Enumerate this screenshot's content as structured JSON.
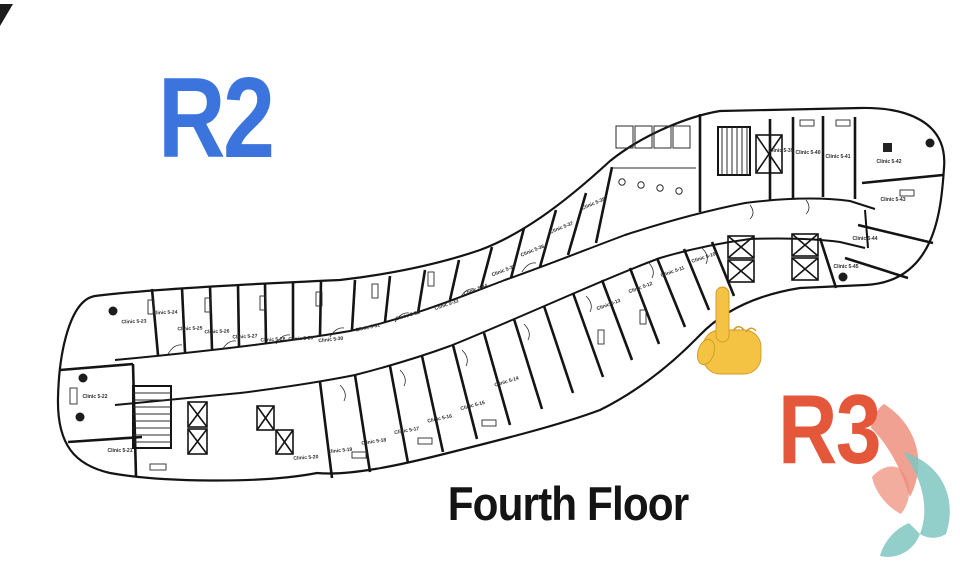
{
  "page": {
    "background": "#ffffff"
  },
  "overlays": {
    "zone_left_label": "R2",
    "zone_left_color": "#3b74dc",
    "zone_right_label": "R3",
    "zone_right_color": "#e4573a",
    "caption": "Fourth Floor",
    "caption_color": "#141414",
    "pointer_icon": "backhand-index-pointing-up",
    "pointer_fill": "#f4c343",
    "pointer_outline": "#d09a25"
  },
  "logo": {
    "coral": "#ec8a76",
    "teal": "#7fc5c1"
  },
  "floorplan": {
    "name": "fourth-floor-clinic-plan",
    "line_color": "#141414",
    "label_color": "#2a2a2a",
    "rooms": [
      {
        "label": "Clinic 5-23",
        "x": 134,
        "y": 323,
        "angle": -2
      },
      {
        "label": "Clinic 5-24",
        "x": 165,
        "y": 314,
        "angle": -2
      },
      {
        "label": "Clinic 5-25",
        "x": 190,
        "y": 330,
        "angle": -2
      },
      {
        "label": "Clinic 5-26",
        "x": 217,
        "y": 333,
        "angle": -2
      },
      {
        "label": "Clinic 5-27",
        "x": 245,
        "y": 338,
        "angle": -3
      },
      {
        "label": "Clinic 5-28",
        "x": 273,
        "y": 341,
        "angle": -3
      },
      {
        "label": "Clinic 5-29",
        "x": 301,
        "y": 340,
        "angle": -4
      },
      {
        "label": "Clinic 5-30",
        "x": 331,
        "y": 341,
        "angle": -6
      },
      {
        "label": "Clinic 5-31",
        "x": 368,
        "y": 329,
        "angle": -12
      },
      {
        "label": "Clinic 5-32",
        "x": 408,
        "y": 317,
        "angle": -16
      },
      {
        "label": "Clinic 5-33",
        "x": 447,
        "y": 306,
        "angle": -19
      },
      {
        "label": "Clinic 5-34",
        "x": 476,
        "y": 291,
        "angle": -20
      },
      {
        "label": "Clinic 5-35",
        "x": 504,
        "y": 272,
        "angle": -21
      },
      {
        "label": "Clinic 5-36",
        "x": 533,
        "y": 252,
        "angle": -22
      },
      {
        "label": "Clinic 5-37",
        "x": 562,
        "y": 229,
        "angle": -22
      },
      {
        "label": "Clinic 5-38",
        "x": 594,
        "y": 205,
        "angle": -23
      },
      {
        "label": "Clinic 5-39",
        "x": 781,
        "y": 152,
        "angle": 0
      },
      {
        "label": "Clinic 5-40",
        "x": 808,
        "y": 154,
        "angle": 0
      },
      {
        "label": "Clinic 5-41",
        "x": 838,
        "y": 158,
        "angle": 0
      },
      {
        "label": "Clinic 5-42",
        "x": 889,
        "y": 163,
        "angle": 0
      },
      {
        "label": "Clinic 5-43",
        "x": 893,
        "y": 201,
        "angle": 0
      },
      {
        "label": "Clinic 5-44",
        "x": 865,
        "y": 240,
        "angle": 0
      },
      {
        "label": "Clinic 5-45",
        "x": 846,
        "y": 268,
        "angle": 0
      },
      {
        "label": "Clinic 5-10",
        "x": 704,
        "y": 259,
        "angle": -18
      },
      {
        "label": "Clinic 5-11",
        "x": 673,
        "y": 273,
        "angle": -19
      },
      {
        "label": "Clinic 5-12",
        "x": 641,
        "y": 289,
        "angle": -20
      },
      {
        "label": "Clinic 5-13",
        "x": 609,
        "y": 306,
        "angle": -20
      },
      {
        "label": "Clinic 5-14",
        "x": 507,
        "y": 383,
        "angle": -17
      },
      {
        "label": "Clinic 5-15",
        "x": 473,
        "y": 407,
        "angle": -15
      },
      {
        "label": "Clinic 5-16",
        "x": 440,
        "y": 420,
        "angle": -12
      },
      {
        "label": "Clinic 5-17",
        "x": 407,
        "y": 432,
        "angle": -10
      },
      {
        "label": "Clinic 5-18",
        "x": 374,
        "y": 443,
        "angle": -8
      },
      {
        "label": "Clinic 5-19",
        "x": 340,
        "y": 452,
        "angle": -6
      },
      {
        "label": "Clinic 5-20",
        "x": 306,
        "y": 459,
        "angle": -4
      },
      {
        "label": "Clinic 5-21",
        "x": 120,
        "y": 452,
        "angle": 0
      },
      {
        "label": "Clinic 5-22",
        "x": 95,
        "y": 398,
        "angle": 0
      }
    ]
  }
}
